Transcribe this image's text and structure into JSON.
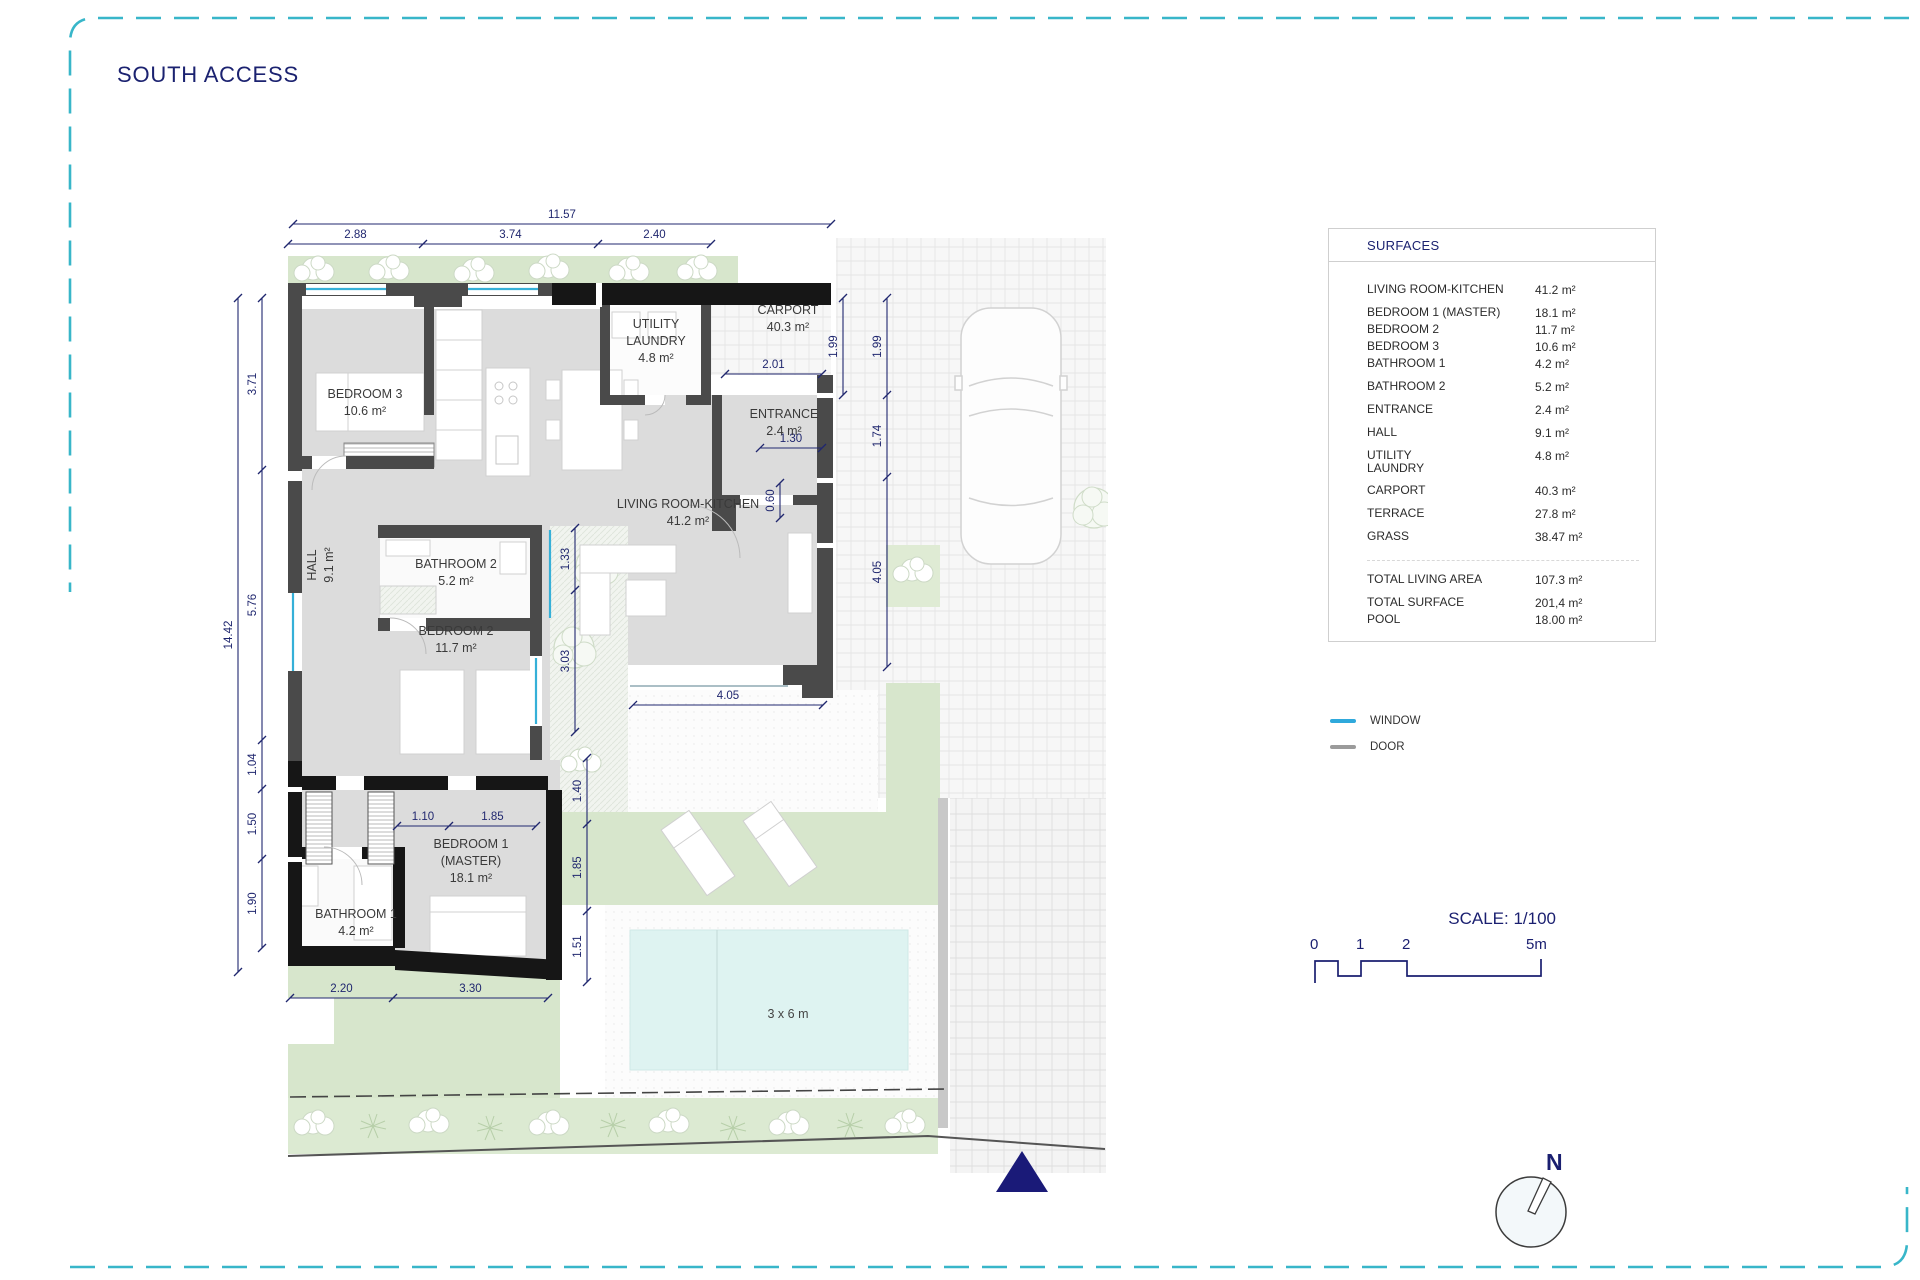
{
  "title": "SOUTH ACCESS",
  "surfaces": {
    "header": "SURFACES",
    "rows": [
      {
        "label": "LIVING ROOM-KITCHEN",
        "value": "41.2 m²",
        "cls": "g"
      },
      {
        "label": "BEDROOM 1 (MASTER)",
        "value": "18.1 m²",
        "cls": "g"
      },
      {
        "label": "BEDROOM 2",
        "value": "11.7 m²",
        "cls": ""
      },
      {
        "label": "BEDROOM 3",
        "value": "10.6 m²",
        "cls": ""
      },
      {
        "label": "BATHROOM 1",
        "value": "4.2 m²",
        "cls": ""
      },
      {
        "label": "BATHROOM 2",
        "value": "5.2 m²",
        "cls": "g"
      },
      {
        "label": "ENTRANCE",
        "value": "2.4 m²",
        "cls": "g"
      },
      {
        "label": "HALL",
        "value": "9.1 m²",
        "cls": "g"
      },
      {
        "label": "UTILITY\nLAUNDRY",
        "value": "4.8 m²",
        "cls": "g"
      },
      {
        "label": "CARPORT",
        "value": "40.3 m²",
        "cls": "g"
      },
      {
        "label": "TERRACE",
        "value": "27.8 m²",
        "cls": "g"
      },
      {
        "label": "GRASS",
        "value": "38.47 m²",
        "cls": "g"
      },
      {
        "label": "TOTAL LIVING AREA",
        "value": "107.3 m²",
        "cls": "sep"
      },
      {
        "label": "TOTAL SURFACE",
        "value": "201,4 m²",
        "cls": "g"
      },
      {
        "label": "POOL",
        "value": "18.00 m²",
        "cls": ""
      }
    ]
  },
  "legend": {
    "window_label": "WINDOW",
    "door_label": "DOOR",
    "window_color": "#2fa9dc",
    "door_color": "#9b9b9b"
  },
  "scale": {
    "title": "SCALE: 1/100",
    "ticks": [
      "0",
      "1",
      "2",
      "5m"
    ]
  },
  "compass": {
    "north_label": "N"
  },
  "colors": {
    "navy": "#1b2270",
    "dashed_border": "#38b6c9",
    "wall": "#4a4a4a",
    "wall_black": "#161616",
    "floor": "#dcdcdc",
    "grass": "#d7e6cc",
    "pool": "#def3f1"
  },
  "plan": {
    "room_labels": [
      {
        "id": "bedroom3",
        "lines": [
          "BEDROOM 3",
          "10.6 m²"
        ],
        "x": 137,
        "y": 200
      },
      {
        "id": "utility",
        "lines": [
          "UTILITY",
          "LAUNDRY",
          "4.8 m²"
        ],
        "x": 428,
        "y": 130
      },
      {
        "id": "carport",
        "lines": [
          "CARPORT",
          "40.3 m²"
        ],
        "x": 560,
        "y": 116
      },
      {
        "id": "entrance",
        "lines": [
          "ENTRANCE",
          "2.4 m²"
        ],
        "x": 556,
        "y": 220
      },
      {
        "id": "living",
        "lines": [
          "LIVING ROOM-KITCHEN",
          "41.2 m²"
        ],
        "x": 460,
        "y": 310
      },
      {
        "id": "hall",
        "lines": [
          "HALL",
          "9.1 m²"
        ],
        "x": 88,
        "y": 367,
        "rot": -90
      },
      {
        "id": "bathroom2",
        "lines": [
          "BATHROOM 2",
          "5.2 m²"
        ],
        "x": 228,
        "y": 370
      },
      {
        "id": "bedroom2",
        "lines": [
          "BEDROOM 2",
          "11.7 m²"
        ],
        "x": 228,
        "y": 437
      },
      {
        "id": "bedroom1",
        "lines": [
          "BEDROOM 1",
          "(MASTER)",
          "18.1 m²"
        ],
        "x": 243,
        "y": 650
      },
      {
        "id": "bathroom1",
        "lines": [
          "BATHROOM 1",
          "4.2 m²"
        ],
        "x": 128,
        "y": 720
      },
      {
        "id": "pool",
        "lines": [
          "3 x 6 m"
        ],
        "x": 560,
        "y": 820,
        "cls": "pool"
      }
    ],
    "dim_chains": {
      "c1": [
        "11.57"
      ],
      "c2": [
        "2.88",
        "3.74",
        "2.40"
      ],
      "c3": [
        "2.01"
      ],
      "c4": [
        "1.30"
      ],
      "c5": [
        "4.05"
      ],
      "c6": [
        "1.10",
        "1.85"
      ],
      "c7": [
        "2.20",
        "3.30"
      ],
      "v1": [
        "14.42"
      ],
      "v2": [
        "3.71",
        "5.76",
        "1.04",
        "1.50",
        "1.90"
      ],
      "v3": [
        "1.99"
      ],
      "v4": [
        "1.99",
        "1.74",
        "4.05"
      ],
      "v5": [
        "0.60"
      ],
      "v6": [
        "1.33",
        "3.03"
      ],
      "v7": [
        "1.40",
        "1.85",
        "1.51"
      ]
    }
  }
}
